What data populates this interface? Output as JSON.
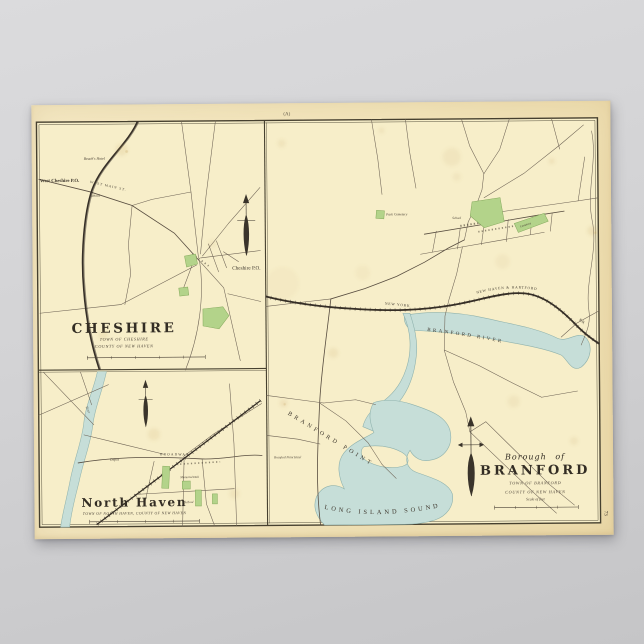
{
  "colors": {
    "background_top": "#dbdbdd",
    "background_bottom": "#c5c5c7",
    "paper": "#f2e5bd",
    "map_surface": "#f7eec9",
    "water": "#c6ded8",
    "water_edge": "#8fb2ad",
    "park_green": "#b3d38a",
    "park_green_edge": "#84a95c",
    "ink": "#3a332a"
  },
  "poster": {
    "plate_mark": "(A)",
    "plate_number": "73"
  },
  "cheshire": {
    "title": "CHESHIRE",
    "town_line": "TOWN OF CHESHIRE",
    "county_line": "COUNTY OF NEW HAVEN",
    "labels": {
      "west_cheshire_po": "West Cheshire P.O.",
      "beachs_hotel": "Beach's Hotel",
      "school": "School",
      "cheshire_po": "Cheshire P.O.",
      "west_main_st": "WEST MAIN ST."
    }
  },
  "north_haven": {
    "title": "North Haven",
    "town_county_line": "TOWN OF NORTH HAVEN, COUNTY OF NEW HAVEN",
    "labels": {
      "depot": "Depot",
      "broadway": "BROADWAY",
      "memorial_hall": "Memorial Hall",
      "school": "School",
      "river": "River"
    }
  },
  "branford": {
    "title_prefix": "Borough of",
    "title": "BRANFORD",
    "town_line": "TOWN OF BRANFORD",
    "county_line": "COUNTY OF NEW HAVEN",
    "scale_label": "Scale of feet",
    "labels": {
      "branford_river": "BRANFORD RIVER",
      "long_island_sound": "LONG ISLAND SOUND",
      "branford_point": "BRANFORD POINT",
      "rail_west": "NEW YORK",
      "rail_mid": "NEW HAVEN & HARTFORD",
      "rail_east": "R.R.",
      "park_cemetery": "Park Cemetery",
      "cemetery": "Cemetery",
      "school": "School",
      "point_hotel": "Branford Point Hotel"
    }
  }
}
